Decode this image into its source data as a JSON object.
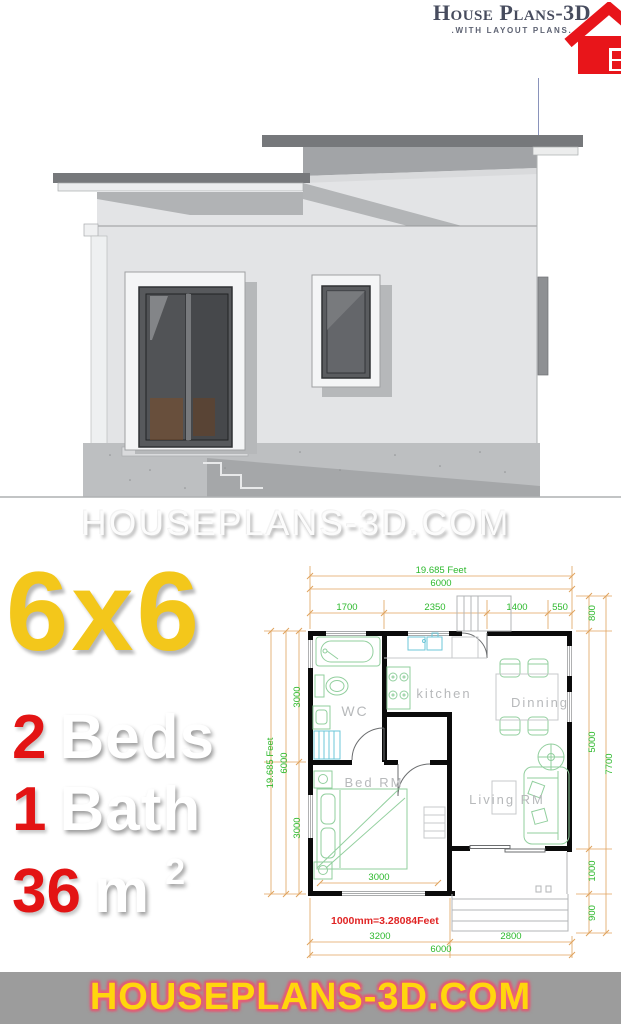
{
  "logo": {
    "title": "House Plans-3D",
    "tagline": ".WITH LAYOUT PLANS."
  },
  "watermark": {
    "text": "HOUSEPLANS-3D.COM"
  },
  "specs": {
    "size": "6x6",
    "beds_value": "2",
    "beds_label": "Beds",
    "bath_value": "1",
    "bath_label": "Bath",
    "area_value": "36",
    "area_unit": "m",
    "area_exponent": "2"
  },
  "footer": {
    "text": "HOUSEPLANS-3D.COM"
  },
  "plan": {
    "note": "1000mm=3.28084Feet",
    "rooms": {
      "kitchen": "kitchen",
      "dining": "Dinning",
      "wc": "WC",
      "bed": "Bed RM",
      "living": "Living RM"
    },
    "dims": {
      "top_feet": "19.685 Feet",
      "top_total": "6000",
      "top_1700": "1700",
      "top_2350": "2350",
      "top_1400": "1400",
      "top_550": "550",
      "right_800": "800",
      "right_5000": "5000",
      "right_1000": "1000",
      "right_900": "900",
      "right_total": "7700",
      "left_3000_top": "3000",
      "left_feet": "19.685 Feet",
      "left_total": "6000",
      "left_3000_bottom": "3000",
      "bed_width": "3000",
      "bottom_3200": "3200",
      "bottom_2800": "2800",
      "bottom_total": "6000"
    },
    "colors": {
      "dim_text": "#2db92d",
      "dim_line": "#e0a35e",
      "wall": "#0b0b0b",
      "fixture": "#92cf9e",
      "note": "#e02424",
      "accent_yellow": "#f3c71b",
      "accent_red": "#e31414",
      "logo_red": "#e8151a",
      "logo_pink": "#f1719f"
    }
  }
}
